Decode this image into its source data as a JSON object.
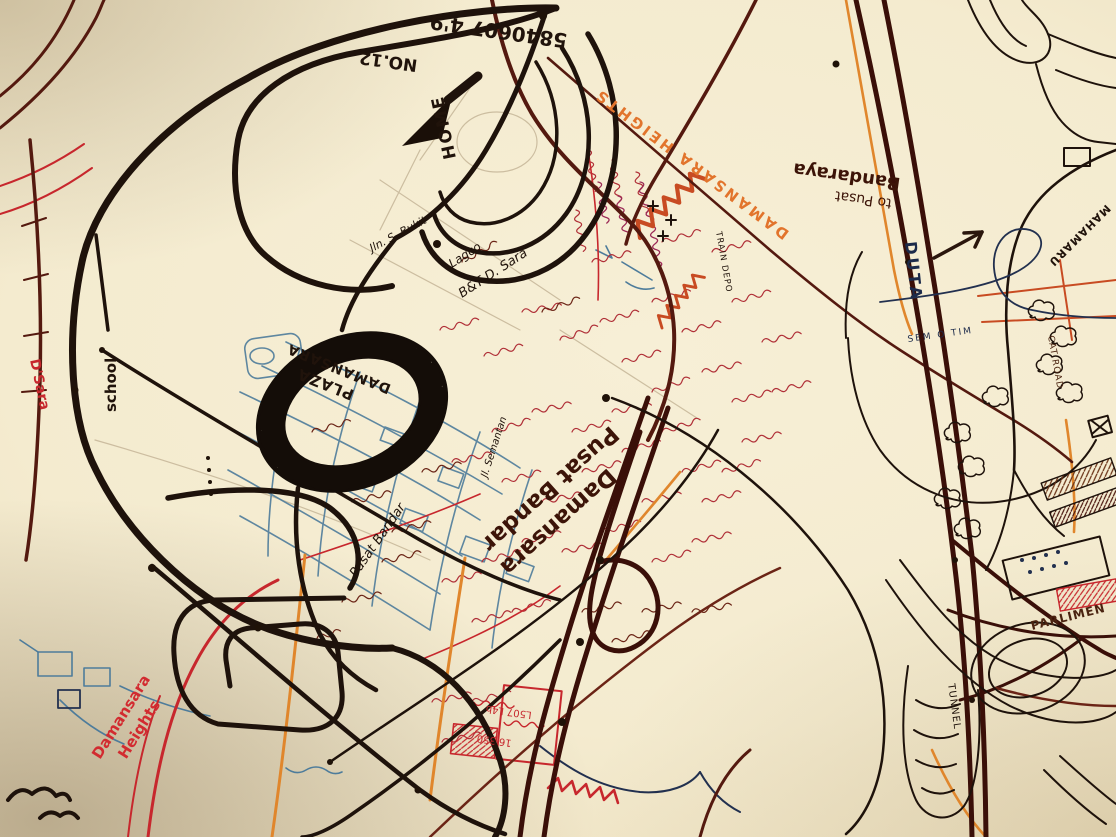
{
  "palette": {
    "paper": "#f4ebd1",
    "black_ink": "#1e120b",
    "maroon_ink": "#54190f",
    "red_ink": "#c7272d",
    "orange_ink": "#e0862c",
    "blue_ink": "#4e7c9b",
    "navy_ink": "#1f2c4d",
    "magenta_ink": "#9c2a56",
    "pencil": "#c2b294"
  },
  "labels": {
    "phone_number": "5840607 4'9",
    "house_number": "NO.12",
    "home": "HOME",
    "jln_s_bukit": "Jln. S. Bukit",
    "lagco": "Lagco",
    "bt_dsara": "B&T D. Sara",
    "jl_semantan": "Jl. Semantan",
    "plaza_line1": "PLAZA",
    "plaza_line2": "DAMANSARA",
    "school": "school",
    "pusat_small": "Pusat Bandar",
    "pusat_big_line1": "Pusat Bandar",
    "pusat_big_line2": "Damansara",
    "dh_red_line1": "Damansara",
    "dh_red_line2": "Heights",
    "dh_orange": "DAMANSARA HEIGHTS",
    "to_pusat_line1": "to Pusat",
    "to_pusat_line2": "Bandaraya",
    "train_depo": "TRAIN DEPO",
    "duta": "DUTA",
    "mahameru": "MAHAMARU",
    "sem_o_tim": "SEM O TIM",
    "cat_road": "CAT ROAD",
    "parlimen": "PARLIMEN",
    "tunnel": "TUNNEL",
    "dsara_edge": "D'Sara",
    "red_note1": "L507 L4b",
    "red_note2": "16 350"
  }
}
